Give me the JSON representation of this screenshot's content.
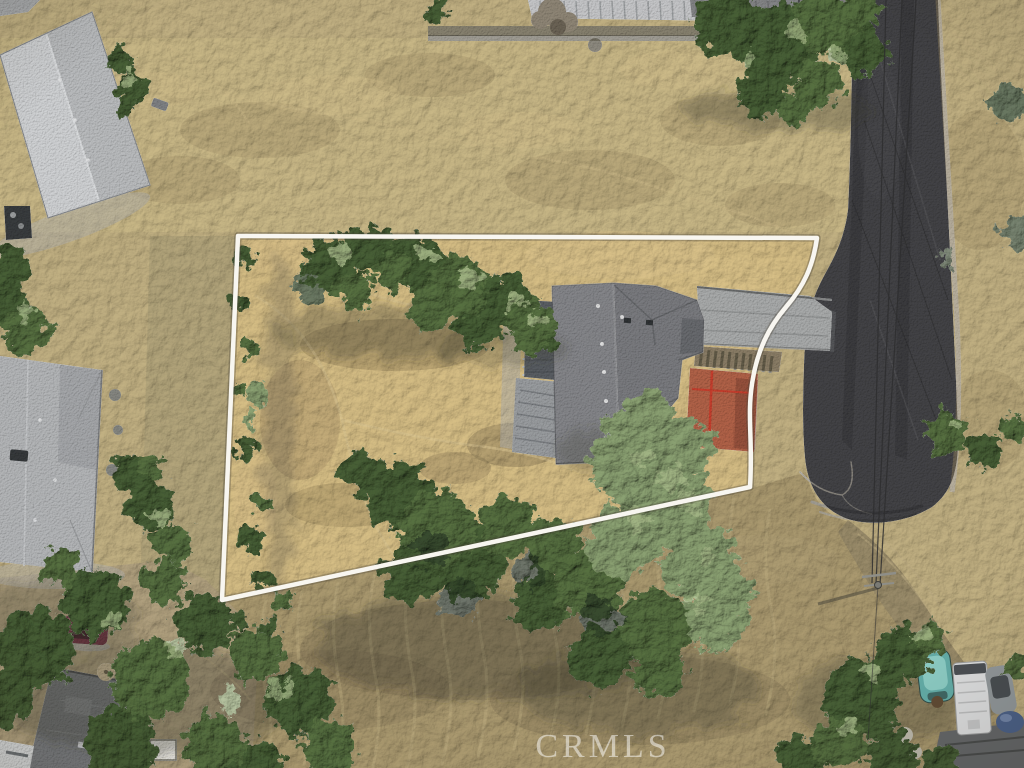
{
  "watermark": {
    "text": "CRMLS",
    "color": "#ffffff"
  },
  "palette": {
    "grass_base": "#c2b183",
    "grass_upper": "#cab987",
    "grass_property": "#d7bf86",
    "grass_left_strip": "#b3a57b",
    "field_lower": "#ab9a70",
    "dirt_lower_left": "#b1a281",
    "road_asphalt": "#434346",
    "dirt_path": "#9a8c6a",
    "concrete_driveway": "#a9abab",
    "wood_stairs": "#8a7d66",
    "deck_red": "#b16248",
    "railing_red": "#c73f2e",
    "roof_main_left": "#85868a",
    "roof_main_right": "#7a7b7f",
    "deck_dark": "#5a5e63",
    "deck_light": "#9a9da0",
    "roof_topleft_light": "#d0d2d4",
    "roof_topleft_dark": "#babcbe",
    "roof_midleft": "#b4b6b8",
    "roof_bottomleft": "#797b7e",
    "roof_corner_shed": "#636567",
    "shed_white": "#eceae4",
    "metal_building": "#c6c7c9",
    "retaining_wall": "#87816f",
    "tree_dark": "#475e36",
    "tree_mid": "#57703f",
    "tree_sage": "#8ba172",
    "tree_light": "#a5b886",
    "shadow": "#3b3b2c",
    "boundary_line": "#f8f6f0",
    "bin_blue": "#4272aa",
    "boat_teal": "#62aaa5",
    "rv_white": "#dadbdc",
    "car_gray": "#8f9598",
    "tarp_blue": "#4a5f86",
    "car_maroon": "#6e3340",
    "car_white": "#d6d8d8",
    "powerline": "#2e2e2f"
  }
}
